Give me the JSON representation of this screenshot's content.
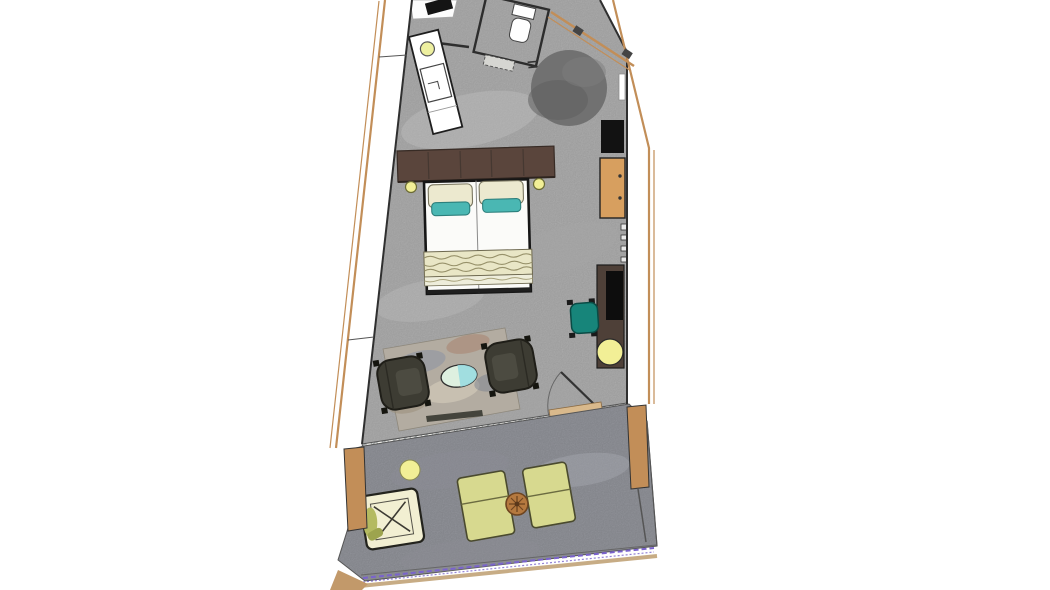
{
  "scene": {
    "kind": "floor-plan-top-view",
    "objects": [
      "entry-mat",
      "partition-wall",
      "bathroom-counter",
      "sink-bowl",
      "basin",
      "shower-enclosure",
      "toilet",
      "bath-mat",
      "round-rug",
      "tv-panel",
      "wardrobe",
      "minibar-hinges",
      "desk",
      "laptop",
      "desk-chair",
      "desk-lamp",
      "headboard",
      "double-bed",
      "pillow-left",
      "pillow-right",
      "accent-pillow-left",
      "accent-pillow-right",
      "throw-blanket",
      "bedside-light-left",
      "bedside-light-right",
      "area-rug",
      "armchair-left",
      "armchair-right",
      "side-table",
      "terrace-door",
      "window-sill-band",
      "facade-window-left",
      "facade-window-right",
      "wood-post-left",
      "wood-post-right",
      "terrace-floor",
      "terrace-ceiling-light",
      "hanging-chair",
      "sun-lounger-left",
      "sun-lounger-right",
      "terrace-table",
      "glass-balustrade"
    ]
  },
  "colors": {
    "background": "#ffffff",
    "room_floor": "#b5b5b5",
    "terrace_floor": "#9a9ca3",
    "wall_line": "#2f2f2f",
    "wood": "#c28e58",
    "wood_light": "#d9b98c",
    "wardrobe": "#d79f5f",
    "round_rug": "#717171",
    "round_rug_shade": "#5f5f5f",
    "tv_panel": "#121212",
    "desk": "#4e4038",
    "laptop": "#0d0d0d",
    "office_chair": "#17857a",
    "headboard": "#5a453c",
    "bed_linen": "#fbfbf9",
    "pillow_cream": "#ece9cf",
    "pillow_teal": "#4ab7b3",
    "throw": "#e9e6c6",
    "throw_band": "#eeeddb",
    "footboard": "#1f1f1f",
    "area_rug": "#b3aca1",
    "armchair": "#3d3c33",
    "side_table_top": "#def0e0",
    "side_table_half": "#9adbe0",
    "light": "#f2ef96",
    "counter": "#ffffff",
    "lounger": "#d7d98f",
    "hanging_chair": "#f2efd2",
    "hanging_chair_accent": "#b4ba60",
    "terrace_table": "#b5793f",
    "balustrade": "#7a63cc",
    "entry_mat": "#141414"
  }
}
